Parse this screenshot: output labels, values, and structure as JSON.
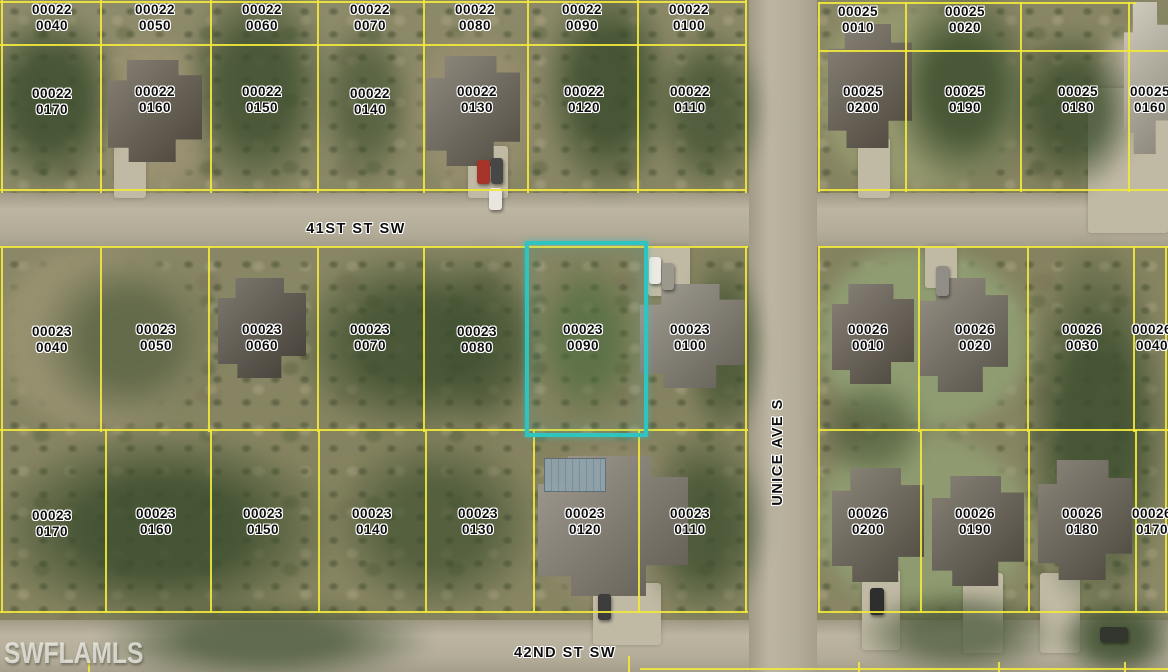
{
  "map": {
    "watermark": "SWFLAMLS",
    "streets": [
      {
        "label": "41ST ST SW"
      },
      {
        "label": "42ND ST SW"
      },
      {
        "label": "UNICE AVE S"
      }
    ],
    "highlight": {
      "parcel_book": "00023",
      "parcel_lot": "0090",
      "color": "#2fc4bf"
    },
    "colors": {
      "parcel_line": "#f0e73c",
      "label_text": "#0d0d0d",
      "label_halo": "#ffffff"
    },
    "parcels": [
      {
        "b": "00022",
        "l": "0040",
        "x": 52,
        "y": 2
      },
      {
        "b": "00022",
        "l": "0050",
        "x": 155,
        "y": 2
      },
      {
        "b": "00022",
        "l": "0060",
        "x": 262,
        "y": 2
      },
      {
        "b": "00022",
        "l": "0070",
        "x": 370,
        "y": 2
      },
      {
        "b": "00022",
        "l": "0080",
        "x": 475,
        "y": 2
      },
      {
        "b": "00022",
        "l": "0090",
        "x": 582,
        "y": 2
      },
      {
        "b": "00022",
        "l": "0100",
        "x": 689,
        "y": 2
      },
      {
        "b": "00025",
        "l": "0010",
        "x": 858,
        "y": 4
      },
      {
        "b": "00025",
        "l": "0020",
        "x": 965,
        "y": 4
      },
      {
        "b": "00022",
        "l": "0170",
        "x": 52,
        "y": 86
      },
      {
        "b": "00022",
        "l": "0160",
        "x": 155,
        "y": 84
      },
      {
        "b": "00022",
        "l": "0150",
        "x": 262,
        "y": 84
      },
      {
        "b": "00022",
        "l": "0140",
        "x": 370,
        "y": 86
      },
      {
        "b": "00022",
        "l": "0130",
        "x": 477,
        "y": 84
      },
      {
        "b": "00022",
        "l": "0120",
        "x": 584,
        "y": 84
      },
      {
        "b": "00022",
        "l": "0110",
        "x": 690,
        "y": 84
      },
      {
        "b": "00025",
        "l": "0200",
        "x": 863,
        "y": 84
      },
      {
        "b": "00025",
        "l": "0190",
        "x": 965,
        "y": 84
      },
      {
        "b": "00025",
        "l": "0180",
        "x": 1078,
        "y": 84
      },
      {
        "b": "00025",
        "l": "0160",
        "x": 1150,
        "y": 84
      },
      {
        "b": "00023",
        "l": "0040",
        "x": 52,
        "y": 324
      },
      {
        "b": "00023",
        "l": "0050",
        "x": 156,
        "y": 322
      },
      {
        "b": "00023",
        "l": "0060",
        "x": 262,
        "y": 322
      },
      {
        "b": "00023",
        "l": "0070",
        "x": 370,
        "y": 322
      },
      {
        "b": "00023",
        "l": "0080",
        "x": 477,
        "y": 324
      },
      {
        "b": "00023",
        "l": "0090",
        "x": 583,
        "y": 322,
        "hl": true
      },
      {
        "b": "00023",
        "l": "0100",
        "x": 690,
        "y": 322
      },
      {
        "b": "00026",
        "l": "0010",
        "x": 868,
        "y": 322
      },
      {
        "b": "00026",
        "l": "0020",
        "x": 975,
        "y": 322
      },
      {
        "b": "00026",
        "l": "0030",
        "x": 1082,
        "y": 322
      },
      {
        "b": "00026",
        "l": "0040",
        "x": 1152,
        "y": 322
      },
      {
        "b": "00023",
        "l": "0170",
        "x": 52,
        "y": 508
      },
      {
        "b": "00023",
        "l": "0160",
        "x": 156,
        "y": 506
      },
      {
        "b": "00023",
        "l": "0150",
        "x": 263,
        "y": 506
      },
      {
        "b": "00023",
        "l": "0140",
        "x": 372,
        "y": 506
      },
      {
        "b": "00023",
        "l": "0130",
        "x": 478,
        "y": 506
      },
      {
        "b": "00023",
        "l": "0120",
        "x": 585,
        "y": 506
      },
      {
        "b": "00023",
        "l": "0110",
        "x": 690,
        "y": 506
      },
      {
        "b": "00026",
        "l": "0200",
        "x": 868,
        "y": 506
      },
      {
        "b": "00026",
        "l": "0190",
        "x": 975,
        "y": 506
      },
      {
        "b": "00026",
        "l": "0180",
        "x": 1082,
        "y": 506
      },
      {
        "b": "00026",
        "l": "0170",
        "x": 1152,
        "y": 506
      }
    ],
    "lines": [
      {
        "x": 1,
        "y": 0,
        "w": 2,
        "h": 193
      },
      {
        "x": 100,
        "y": 0,
        "w": 2,
        "h": 193
      },
      {
        "x": 210,
        "y": 0,
        "w": 2,
        "h": 193
      },
      {
        "x": 317,
        "y": 0,
        "w": 2,
        "h": 193
      },
      {
        "x": 423,
        "y": 0,
        "w": 2,
        "h": 193
      },
      {
        "x": 527,
        "y": 0,
        "w": 2,
        "h": 193
      },
      {
        "x": 637,
        "y": 0,
        "w": 2,
        "h": 193
      },
      {
        "x": 745,
        "y": 0,
        "w": 2,
        "h": 193
      },
      {
        "x": 818,
        "y": 2,
        "w": 2,
        "h": 190
      },
      {
        "x": 905,
        "y": 2,
        "w": 2,
        "h": 190
      },
      {
        "x": 1020,
        "y": 2,
        "w": 2,
        "h": 190
      },
      {
        "x": 1128,
        "y": 2,
        "w": 2,
        "h": 190
      },
      {
        "x": 0,
        "y": 1,
        "w": 746,
        "h": 2
      },
      {
        "x": 818,
        "y": 2,
        "w": 318,
        "h": 2
      },
      {
        "x": 0,
        "y": 44,
        "w": 746,
        "h": 2
      },
      {
        "x": 818,
        "y": 50,
        "w": 350,
        "h": 2
      },
      {
        "x": 0,
        "y": 189,
        "w": 746,
        "h": 2
      },
      {
        "x": 818,
        "y": 189,
        "w": 350,
        "h": 2
      },
      {
        "x": 0,
        "y": 246,
        "w": 748,
        "h": 2
      },
      {
        "x": 818,
        "y": 246,
        "w": 350,
        "h": 2
      },
      {
        "x": 1,
        "y": 246,
        "w": 2,
        "h": 186
      },
      {
        "x": 100,
        "y": 246,
        "w": 2,
        "h": 186
      },
      {
        "x": 208,
        "y": 246,
        "w": 2,
        "h": 186
      },
      {
        "x": 317,
        "y": 246,
        "w": 2,
        "h": 186
      },
      {
        "x": 423,
        "y": 246,
        "w": 2,
        "h": 186
      },
      {
        "x": 745,
        "y": 246,
        "w": 2,
        "h": 186
      },
      {
        "x": 818,
        "y": 246,
        "w": 2,
        "h": 186
      },
      {
        "x": 918,
        "y": 246,
        "w": 2,
        "h": 186
      },
      {
        "x": 1027,
        "y": 246,
        "w": 2,
        "h": 186
      },
      {
        "x": 1133,
        "y": 246,
        "w": 2,
        "h": 186
      },
      {
        "x": 1165,
        "y": 246,
        "w": 2,
        "h": 186
      },
      {
        "x": 0,
        "y": 429,
        "w": 748,
        "h": 2
      },
      {
        "x": 818,
        "y": 429,
        "w": 350,
        "h": 2
      },
      {
        "x": 1,
        "y": 429,
        "w": 2,
        "h": 184
      },
      {
        "x": 105,
        "y": 429,
        "w": 2,
        "h": 184
      },
      {
        "x": 210,
        "y": 429,
        "w": 2,
        "h": 184
      },
      {
        "x": 318,
        "y": 429,
        "w": 2,
        "h": 184
      },
      {
        "x": 425,
        "y": 429,
        "w": 2,
        "h": 184
      },
      {
        "x": 533,
        "y": 429,
        "w": 2,
        "h": 184
      },
      {
        "x": 638,
        "y": 429,
        "w": 2,
        "h": 184
      },
      {
        "x": 745,
        "y": 429,
        "w": 2,
        "h": 184
      },
      {
        "x": 818,
        "y": 429,
        "w": 2,
        "h": 184
      },
      {
        "x": 920,
        "y": 429,
        "w": 2,
        "h": 184
      },
      {
        "x": 1028,
        "y": 429,
        "w": 2,
        "h": 184
      },
      {
        "x": 1135,
        "y": 429,
        "w": 2,
        "h": 184
      },
      {
        "x": 1165,
        "y": 429,
        "w": 2,
        "h": 184
      },
      {
        "x": 0,
        "y": 611,
        "w": 748,
        "h": 2
      },
      {
        "x": 818,
        "y": 611,
        "w": 350,
        "h": 2
      },
      {
        "x": 640,
        "y": 668,
        "w": 528,
        "h": 2
      },
      {
        "x": 88,
        "y": 660,
        "w": 2,
        "h": 12
      },
      {
        "x": 628,
        "y": 656,
        "w": 2,
        "h": 16
      },
      {
        "x": 858,
        "y": 662,
        "w": 2,
        "h": 10
      },
      {
        "x": 998,
        "y": 662,
        "w": 2,
        "h": 10
      },
      {
        "x": 1124,
        "y": 662,
        "w": 2,
        "h": 10
      }
    ],
    "scene": {
      "lawns": [
        {
          "x": 0,
          "y": 248,
          "w": 205,
          "h": 180,
          "c": "#96906f"
        },
        {
          "x": 820,
          "y": 5,
          "w": 200,
          "h": 185,
          "c": "#95986f"
        },
        {
          "x": 820,
          "y": 250,
          "w": 210,
          "h": 178,
          "c": "#8f9c72"
        },
        {
          "x": 820,
          "y": 432,
          "w": 210,
          "h": 178,
          "c": "#8f9a70"
        },
        {
          "x": 96,
          "y": 40,
          "w": 112,
          "h": 150,
          "c": "#999171"
        },
        {
          "x": 418,
          "y": 35,
          "w": 115,
          "h": 155,
          "c": "#958d6e"
        },
        {
          "x": 542,
          "y": 445,
          "w": 155,
          "h": 170,
          "c": "#8d8769"
        },
        {
          "x": 1092,
          "y": 35,
          "w": 76,
          "h": 195,
          "c": "#b3ac96"
        }
      ],
      "veg": [
        {
          "x": -25,
          "y": 5,
          "w": 150,
          "h": 190,
          "o": 0.85
        },
        {
          "x": 182,
          "y": -25,
          "w": 150,
          "h": 225,
          "o": 0.8
        },
        {
          "x": 318,
          "y": 15,
          "w": 95,
          "h": 175,
          "o": 0.6
        },
        {
          "x": 540,
          "y": -25,
          "w": 135,
          "h": 225,
          "o": 0.85
        },
        {
          "x": 652,
          "y": 25,
          "w": 115,
          "h": 170,
          "o": 0.7
        },
        {
          "x": 888,
          "y": -15,
          "w": 150,
          "h": 205,
          "o": 0.85
        },
        {
          "x": 1005,
          "y": 25,
          "w": 135,
          "h": 170,
          "o": 0.8
        },
        {
          "x": 35,
          "y": 252,
          "w": 190,
          "h": 175,
          "o": 0.55
        },
        {
          "x": 288,
          "y": 248,
          "w": 255,
          "h": 190,
          "o": 0.8
        },
        {
          "x": 432,
          "y": 245,
          "w": 110,
          "h": 195,
          "o": 0.5
        },
        {
          "x": 532,
          "y": 252,
          "w": 110,
          "h": 175,
          "o": 0.65,
          "c": "#4c6b3c"
        },
        {
          "x": 682,
          "y": 250,
          "w": 85,
          "h": 195,
          "o": 0.7
        },
        {
          "x": 1022,
          "y": 238,
          "w": 150,
          "h": 385,
          "o": 0.85
        },
        {
          "x": -15,
          "y": 428,
          "w": 355,
          "h": 200,
          "o": 0.85
        },
        {
          "x": 328,
          "y": 432,
          "w": 215,
          "h": 185,
          "o": 0.65
        },
        {
          "x": 636,
          "y": 428,
          "w": 135,
          "h": 195,
          "o": 0.75
        },
        {
          "x": 95,
          "y": 598,
          "w": 340,
          "h": 85,
          "o": 0.7
        },
        {
          "x": 855,
          "y": 588,
          "w": 205,
          "h": 90,
          "o": 0.65
        },
        {
          "x": 1055,
          "y": 595,
          "w": 125,
          "h": 85,
          "o": 0.85
        },
        {
          "x": 815,
          "y": 375,
          "w": 115,
          "h": 110,
          "o": 0.5
        }
      ],
      "driveways": [
        {
          "x": 114,
          "y": 146,
          "w": 32,
          "h": 52
        },
        {
          "x": 468,
          "y": 146,
          "w": 40,
          "h": 52
        },
        {
          "x": 858,
          "y": 138,
          "w": 32,
          "h": 60
        },
        {
          "x": 1088,
          "y": 88,
          "w": 80,
          "h": 145
        },
        {
          "x": 648,
          "y": 246,
          "w": 42,
          "h": 50
        },
        {
          "x": 925,
          "y": 246,
          "w": 32,
          "h": 42
        },
        {
          "x": 593,
          "y": 583,
          "w": 68,
          "h": 62
        },
        {
          "x": 862,
          "y": 570,
          "w": 38,
          "h": 80
        },
        {
          "x": 963,
          "y": 573,
          "w": 40,
          "h": 80
        },
        {
          "x": 1040,
          "y": 573,
          "w": 40,
          "h": 80
        }
      ],
      "houses": [
        {
          "x": 108,
          "y": 60,
          "w": 94,
          "h": 102,
          "c": "#6a6152"
        },
        {
          "x": 426,
          "y": 56,
          "w": 94,
          "h": 110,
          "c": "#746d5f"
        },
        {
          "x": 828,
          "y": 24,
          "w": 84,
          "h": 124,
          "c": "#6d6456"
        },
        {
          "x": 1124,
          "y": 2,
          "w": 44,
          "h": 152,
          "c": "#c6c0ae"
        },
        {
          "x": 218,
          "y": 278,
          "w": 88,
          "h": 100,
          "c": "#5f584c"
        },
        {
          "x": 640,
          "y": 284,
          "w": 106,
          "h": 104,
          "c": "#8b8679"
        },
        {
          "x": 832,
          "y": 284,
          "w": 82,
          "h": 100,
          "c": "#6b6356"
        },
        {
          "x": 918,
          "y": 278,
          "w": 90,
          "h": 114,
          "c": "#7c7567"
        },
        {
          "x": 538,
          "y": 456,
          "w": 150,
          "h": 140,
          "c": "#8a8376"
        },
        {
          "x": 832,
          "y": 468,
          "w": 92,
          "h": 114,
          "c": "#6f6859"
        },
        {
          "x": 932,
          "y": 476,
          "w": 92,
          "h": 110,
          "c": "#6a6355"
        },
        {
          "x": 1038,
          "y": 460,
          "w": 94,
          "h": 120,
          "c": "#6e6759"
        }
      ],
      "pool": {
        "x": 544,
        "y": 458,
        "w": 60,
        "h": 32
      },
      "vehicles": [
        {
          "x": 477,
          "y": 160,
          "w": 13,
          "h": 24,
          "c": "#a63428"
        },
        {
          "x": 491,
          "y": 158,
          "w": 12,
          "h": 26,
          "c": "#474747"
        },
        {
          "x": 489,
          "y": 188,
          "w": 13,
          "h": 22,
          "c": "#e8e6df"
        },
        {
          "x": 649,
          "y": 257,
          "w": 12,
          "h": 27,
          "c": "#eceae2"
        },
        {
          "x": 662,
          "y": 263,
          "w": 12,
          "h": 27,
          "c": "#9b988e"
        },
        {
          "x": 936,
          "y": 266,
          "w": 13,
          "h": 30,
          "c": "#8f8d85"
        },
        {
          "x": 598,
          "y": 594,
          "w": 13,
          "h": 26,
          "c": "#3c3c3c"
        },
        {
          "x": 870,
          "y": 588,
          "w": 14,
          "h": 27,
          "c": "#2e2e2e"
        },
        {
          "x": 1100,
          "y": 627,
          "w": 28,
          "h": 15,
          "c": "#33352f"
        }
      ]
    }
  }
}
